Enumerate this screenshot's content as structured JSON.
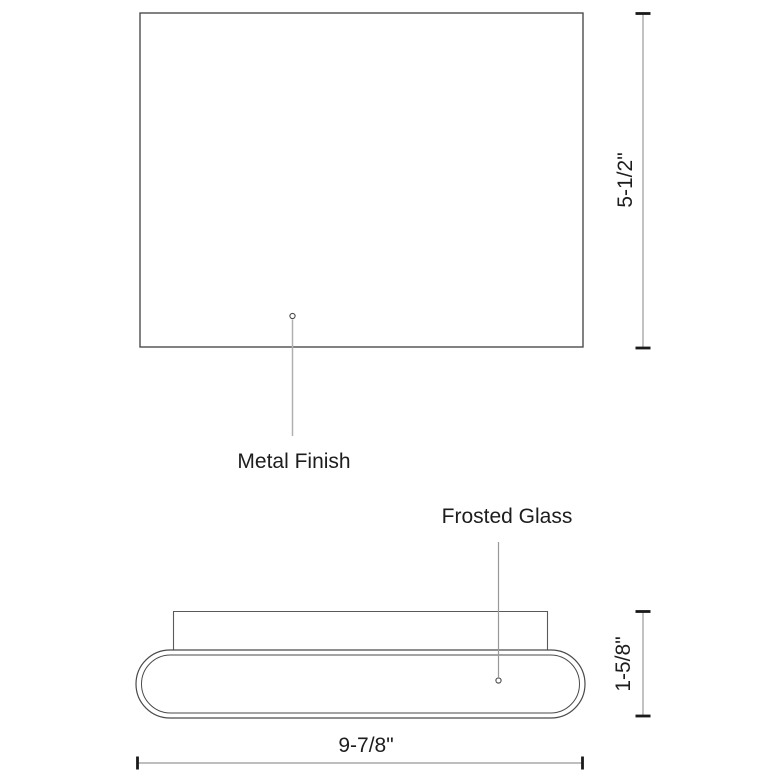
{
  "canvas": {
    "width": 780,
    "height": 780,
    "background": "#ffffff"
  },
  "colors": {
    "primary_outline": "#3f3f3f",
    "secondary_outline": "#5a5a5a",
    "dimension_line": "#a8a8a8",
    "dimension_tick": "#1a1a1a",
    "leader_line": "#a8a8a8",
    "label_text": "#1d1d1d"
  },
  "views": {
    "front": {
      "callout": "Metal Finish",
      "height_dimension": "5-1/2\""
    },
    "bottom": {
      "callout": "Frosted Glass",
      "depth_dimension": "1-5/8\"",
      "width_dimension": "9-7/8\""
    }
  }
}
